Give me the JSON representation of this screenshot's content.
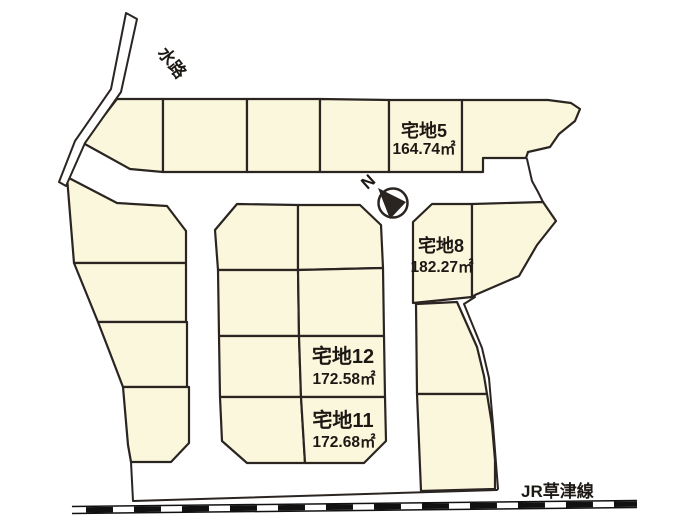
{
  "labels": {
    "waterway": "水路",
    "railway": "JR草津線",
    "north": "N"
  },
  "plots": [
    {
      "name": "宅地5",
      "area": "164.74㎡"
    },
    {
      "name": "宅地8",
      "area": "182.27㎡"
    },
    {
      "name": "宅地12",
      "area": "172.58㎡"
    },
    {
      "name": "宅地11",
      "area": "172.68㎡"
    }
  ],
  "colors": {
    "plot_fill": "#FBF7DC",
    "outline": "#2B2522",
    "text": "#1C1814",
    "railway": "#111111",
    "background": "#FFFFFF"
  }
}
